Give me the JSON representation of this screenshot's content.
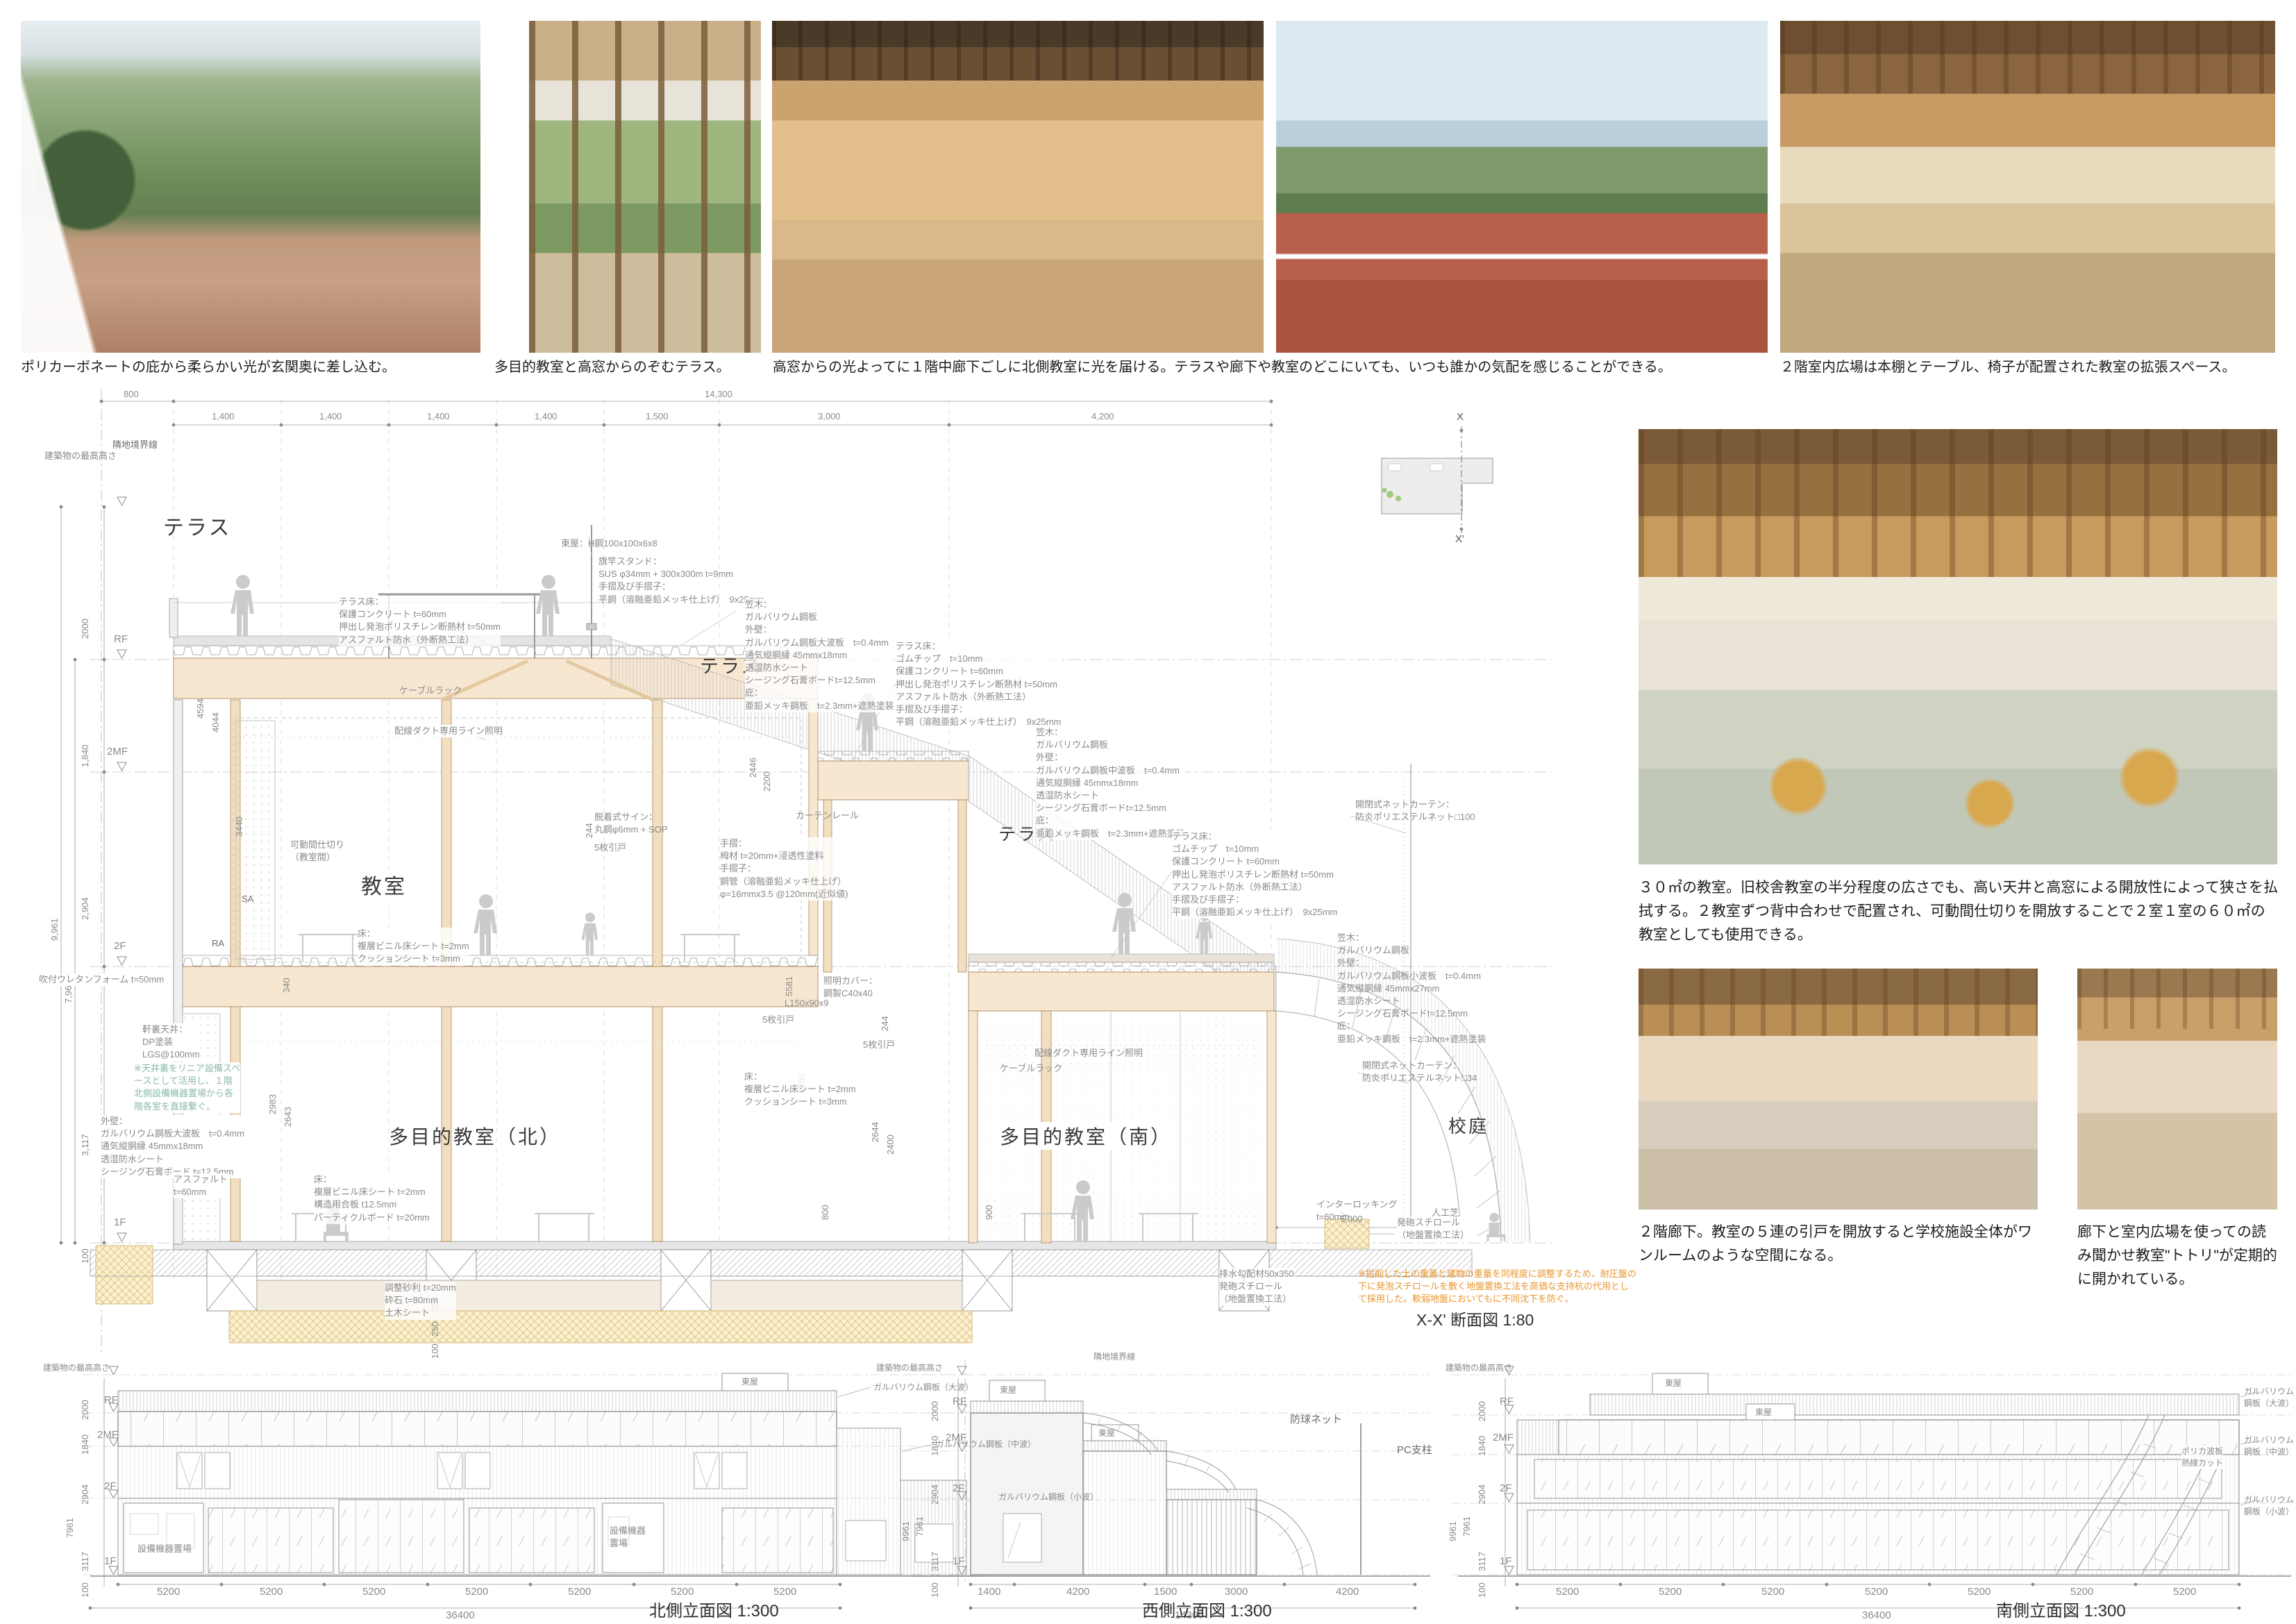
{
  "captions": {
    "c1": "ポリカーボネートの庇から柔らかい光が玄関奥に差し込む。",
    "c2": "多目的教室と高窓からのぞむテラス。",
    "c3": "高窓からの光よってに１階中廊下ごしに北側教室に光を届ける。テラスや廊下や教室のどこにいても、いつも誰かの気配を感じることができる。",
    "c4": "２階室内広場は本棚とテーブル、椅子が配置された教室の拡張スペース。"
  },
  "texts": {
    "t1": "３０㎡の教室。旧校舎教室の半分程度の広さでも、高い天井と高窓による開放性によって狭さを払拭する。２教室ずつ背中合わせで配置され、可動間仕切りを開放することで２室１室の６０㎡の教室としても使用できる。",
    "t2": "２階廊下。教室の５連の引戸を開放すると学校施設全体がワンルームのような空間になる。",
    "t3": "廊下と室内広場を使っての読み聞かせ教室\"トトリ\"が定期的に開かれている。"
  },
  "keyplan": {
    "x": "X",
    "xp": "X'"
  },
  "levels": {
    "rf": "RF",
    "mf": "2MF",
    "f2": "2F",
    "f1": "1F"
  },
  "common": {
    "max_height": "建築物の最高高さ",
    "boundary": "隣地境界線",
    "azumaya": "東屋",
    "equip": "設備機器置場",
    "equip2": "設備機器\n置場"
  },
  "section": {
    "title": "X-X' 断面図  1:80",
    "dims_top": {
      "d800": "800",
      "d14300": "14,300"
    },
    "grid": [
      "1,400",
      "1,400",
      "1,400",
      "1,400",
      "1,500",
      "3,000",
      "4,200"
    ],
    "dims_left": {
      "d2000": "2000",
      "d1840": "1,840",
      "d2904": "2,904",
      "d9961": "9,961",
      "d7961": "7,961",
      "d3117": "3,117",
      "d100": "100"
    },
    "dims_inner": {
      "d4594": "4594",
      "d4044": "4044",
      "d2446": "2446",
      "d2200": "2200",
      "d3440": "3440",
      "d340": "340",
      "d2983": "2983",
      "d2643": "2643",
      "d244": "244",
      "d2280": "2280",
      "d5581": "5581",
      "d2644": "2644",
      "d2400": "2400",
      "d800": "800",
      "d900": "900",
      "d350": "350",
      "d250": "250",
      "d100": "100",
      "d5000": "5,000"
    },
    "rooms": {
      "terrace": "テラス",
      "kyoshitsu": "教室",
      "tamoku_n": "多目的教室（北）",
      "tamoku_s": "多目的教室（南）",
      "kotei": "校庭"
    },
    "labels": {
      "azumaya_spec": "東屋：H鋼100x100x6x8",
      "flag": "旗竿スタンド：\nSUS φ34mm + 300x300m t=9mm\n手摺及び手摺子：\n平鋼（溶融亜鉛メッキ仕上げ）　9x25mm",
      "tfloor_a": "テラス床：\n保護コンクリート t=60mm\n押出し発泡ポリスチレン断熱材 t=50mm\nアスファルト防水（外断熱工法）",
      "tfloor_b": "テラス床：\nゴムチップ　t=10mm\n保護コンクリート t=60mm\n押出し発泡ポリスチレン断熱材 t=50mm\nアスファルト防水（外断熱工法）\n手摺及び手摺子：\n平鋼（溶融亜鉛メッキ仕上げ）　9x25mm",
      "cable": "ケーブルラック",
      "duct_light": "配線ダクト専用ライン照明",
      "kasagi_big": "笠木：\nガルバリウム鋼板\n外壁：\nガルバリウム鋼板大波板　t=0.4mm\n通気縦胴縁 45mmx18mm\n透湿防水シート\nシージング石膏ボードt=12.5mm\n庇：\n亜鉛メッキ鋼板　t=2.3mm+遮熱塗装",
      "kasagi_mid": "笠木：\nガルバリウム鋼板\n外壁：\nガルバリウム鋼板中波板　t=0.4mm\n通気縦胴縁 45mmx18mm\n透湿防水シート\nシージング石膏ボードt=12.5mm\n庇：\n亜鉛メッキ鋼板　t=2.3mm+遮熱塗装",
      "kasagi_small": "笠木：\nガルバリウム鋼板\n外壁：\nガルバリウム鋼板小波板　t=0.4mm\n通気縦胴縁 45mmx27mm\n透湿防水シート\nシージング石膏ボードt=12.5mm\n庇：\n亜鉛メッキ鋼板　t=2.3mm+遮熱塗装",
      "net100": "開閉式ネットカーテン：\n防炎ポリエステルネット□100",
      "net34": "開閉式ネットカーテン：\n防炎ポリエステルネット□34",
      "sign": "脱着式サイン：\n丸鋼φ6mm + SOP",
      "door5": "5枚引戸",
      "curtain_rail": "カーテンレール",
      "handrail": "手摺：\n栂材 t=20mm+浸透性塗料\n手摺子：\n鋼管（溶融亜鉛メッキ仕上げ）\nφ=16mmx3.5 @120mm(近似値)",
      "partition": "可動間仕切り\n（教室間）",
      "floor_a": "床：\n複層ビニル床シート t=2mm\nクッションシート t=3mm",
      "floor_b": "床：\n複層ビニル床シート t=2mm\n構造用合板 t12.5mm\nパーティクルボード t=20mm",
      "eaves": "軒裏天井：\nDP塗装\nLGS@100mm",
      "wall_big": "外壁：\nガルバリウム鋼板大波板　t=0.4mm\n通気縦胴縁 45mmx18mm\n透湿防水シート\nシージング石膏ボード t=12.5mm",
      "asphalt": "アスファルト\nt=60mm",
      "urethane": "吹付ウレタンフォーム t=50mm",
      "interlock": "インターロッキング\nt=60mm",
      "turf": "人工芝",
      "eps": "発砲スチロール\n（地盤置換工法）",
      "drain": "排水勾配材50x350\n発砲スチロール\n（地盤置換工法）",
      "gravel": "調整砂利 t=20mm\n砕石 t=80mm\n土木シート",
      "l_angle": "L150x90x9",
      "light_cover": "照明カバー：\n鋼製C40x40",
      "sa": "SA",
      "ra": "RA"
    },
    "notes": {
      "teal": "※天井裏をリニア設備スペ\nースとして活用し、１階\n北側設備機器置場から各\n階各室を直接繋ぐ。",
      "orange": "※掘削した土の重量と建物の重量を同程度に調整するため、耐圧盤の\n下に発泡スチロールを敷く地盤置換工法を高価な支持杭の代用とし\nて採用した。軟弱地盤においてもに不同沈下を防ぐ。"
    }
  },
  "elev": {
    "north": {
      "title": "北側立面図  1:300",
      "lbl_onami": "ガルバリウム鋼板（大波）",
      "lbl_chunami": "ガルバリウム鋼板（中波）",
      "lbl_konami": "ガルバリウム鋼板（小波）",
      "dims_bottom": [
        "5200",
        "5200",
        "5200",
        "5200",
        "5200",
        "5200",
        "5200"
      ],
      "total": "36400",
      "dims_left": [
        "2000",
        "1840",
        "2904",
        "7961",
        "3117",
        "100"
      ]
    },
    "west": {
      "title": "西側立面図  1:300",
      "net": "防球ネット",
      "pc": "PC支柱",
      "dims_bottom": [
        "1400",
        "4200",
        "1500",
        "3000",
        "4200"
      ],
      "total": "14300",
      "dims_left": [
        "2000",
        "1840",
        "2904",
        "9961",
        "7961",
        "3117",
        "100"
      ]
    },
    "south": {
      "title": "南側立面図  1:300",
      "lbl_onami": "ガルバリウム鋼板（大波）",
      "lbl_chunami": "ガルバリウム鋼板（中波）",
      "lbl_polyca": "ポリカ波板\n熱線カット",
      "lbl_konami": "ガルバリウム鋼板（小波）",
      "dims_bottom": [
        "5200",
        "5200",
        "5200",
        "5200",
        "5200",
        "5200",
        "5200"
      ],
      "total": "36400",
      "dims_left": [
        "2000",
        "1840",
        "2904",
        "9961",
        "7961",
        "3117",
        "100"
      ]
    }
  }
}
